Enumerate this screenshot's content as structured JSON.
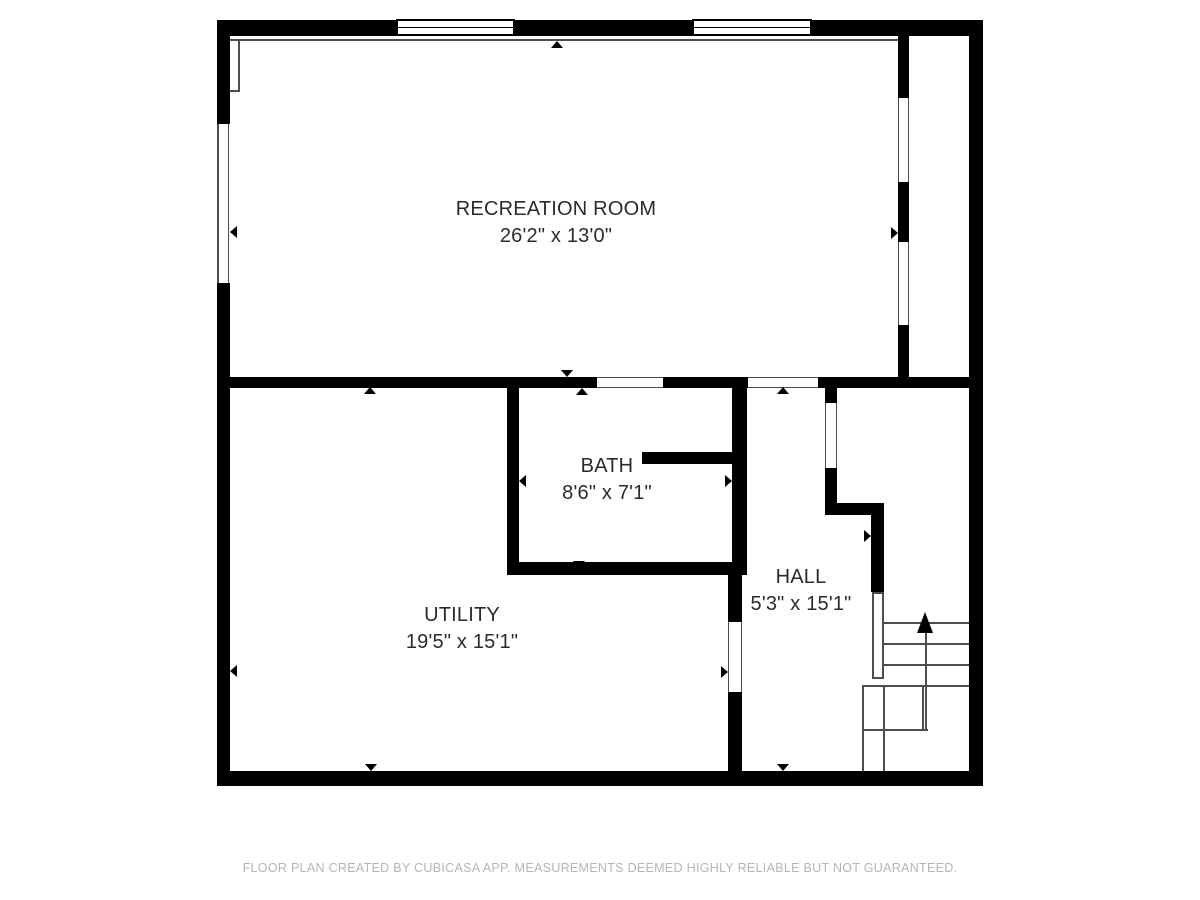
{
  "plan": {
    "title": "Basement floor plan",
    "rooms": [
      {
        "id": "recreation-room",
        "name": "RECREATION ROOM",
        "dimensions": "26'2\" x 13'0\""
      },
      {
        "id": "bath",
        "name": "BATH",
        "dimensions": "8'6\" x 7'1\""
      },
      {
        "id": "utility",
        "name": "UTILITY",
        "dimensions": "19'5\" x 15'1\""
      },
      {
        "id": "hall",
        "name": "HALL",
        "dimensions": "5'3\" x 15'1\""
      }
    ],
    "stairs": {
      "direction": "up",
      "icon": "stairs-up-arrow-icon",
      "treads": 4
    },
    "windows": [
      {
        "id": "window-1",
        "wall": "top",
        "type": "window"
      },
      {
        "id": "window-2",
        "wall": "top",
        "type": "window"
      }
    ],
    "footer": "FLOOR PLAN CREATED BY CUBICASA APP. MEASUREMENTS DEEMED HIGHLY RELIABLE BUT NOT GUARANTEED.",
    "colors": {
      "wall": "#000000",
      "thin_line": "#4d4d4d",
      "label_text": "#2b2b2b",
      "footer_text": "#b5b5b5",
      "background": "#ffffff"
    }
  }
}
